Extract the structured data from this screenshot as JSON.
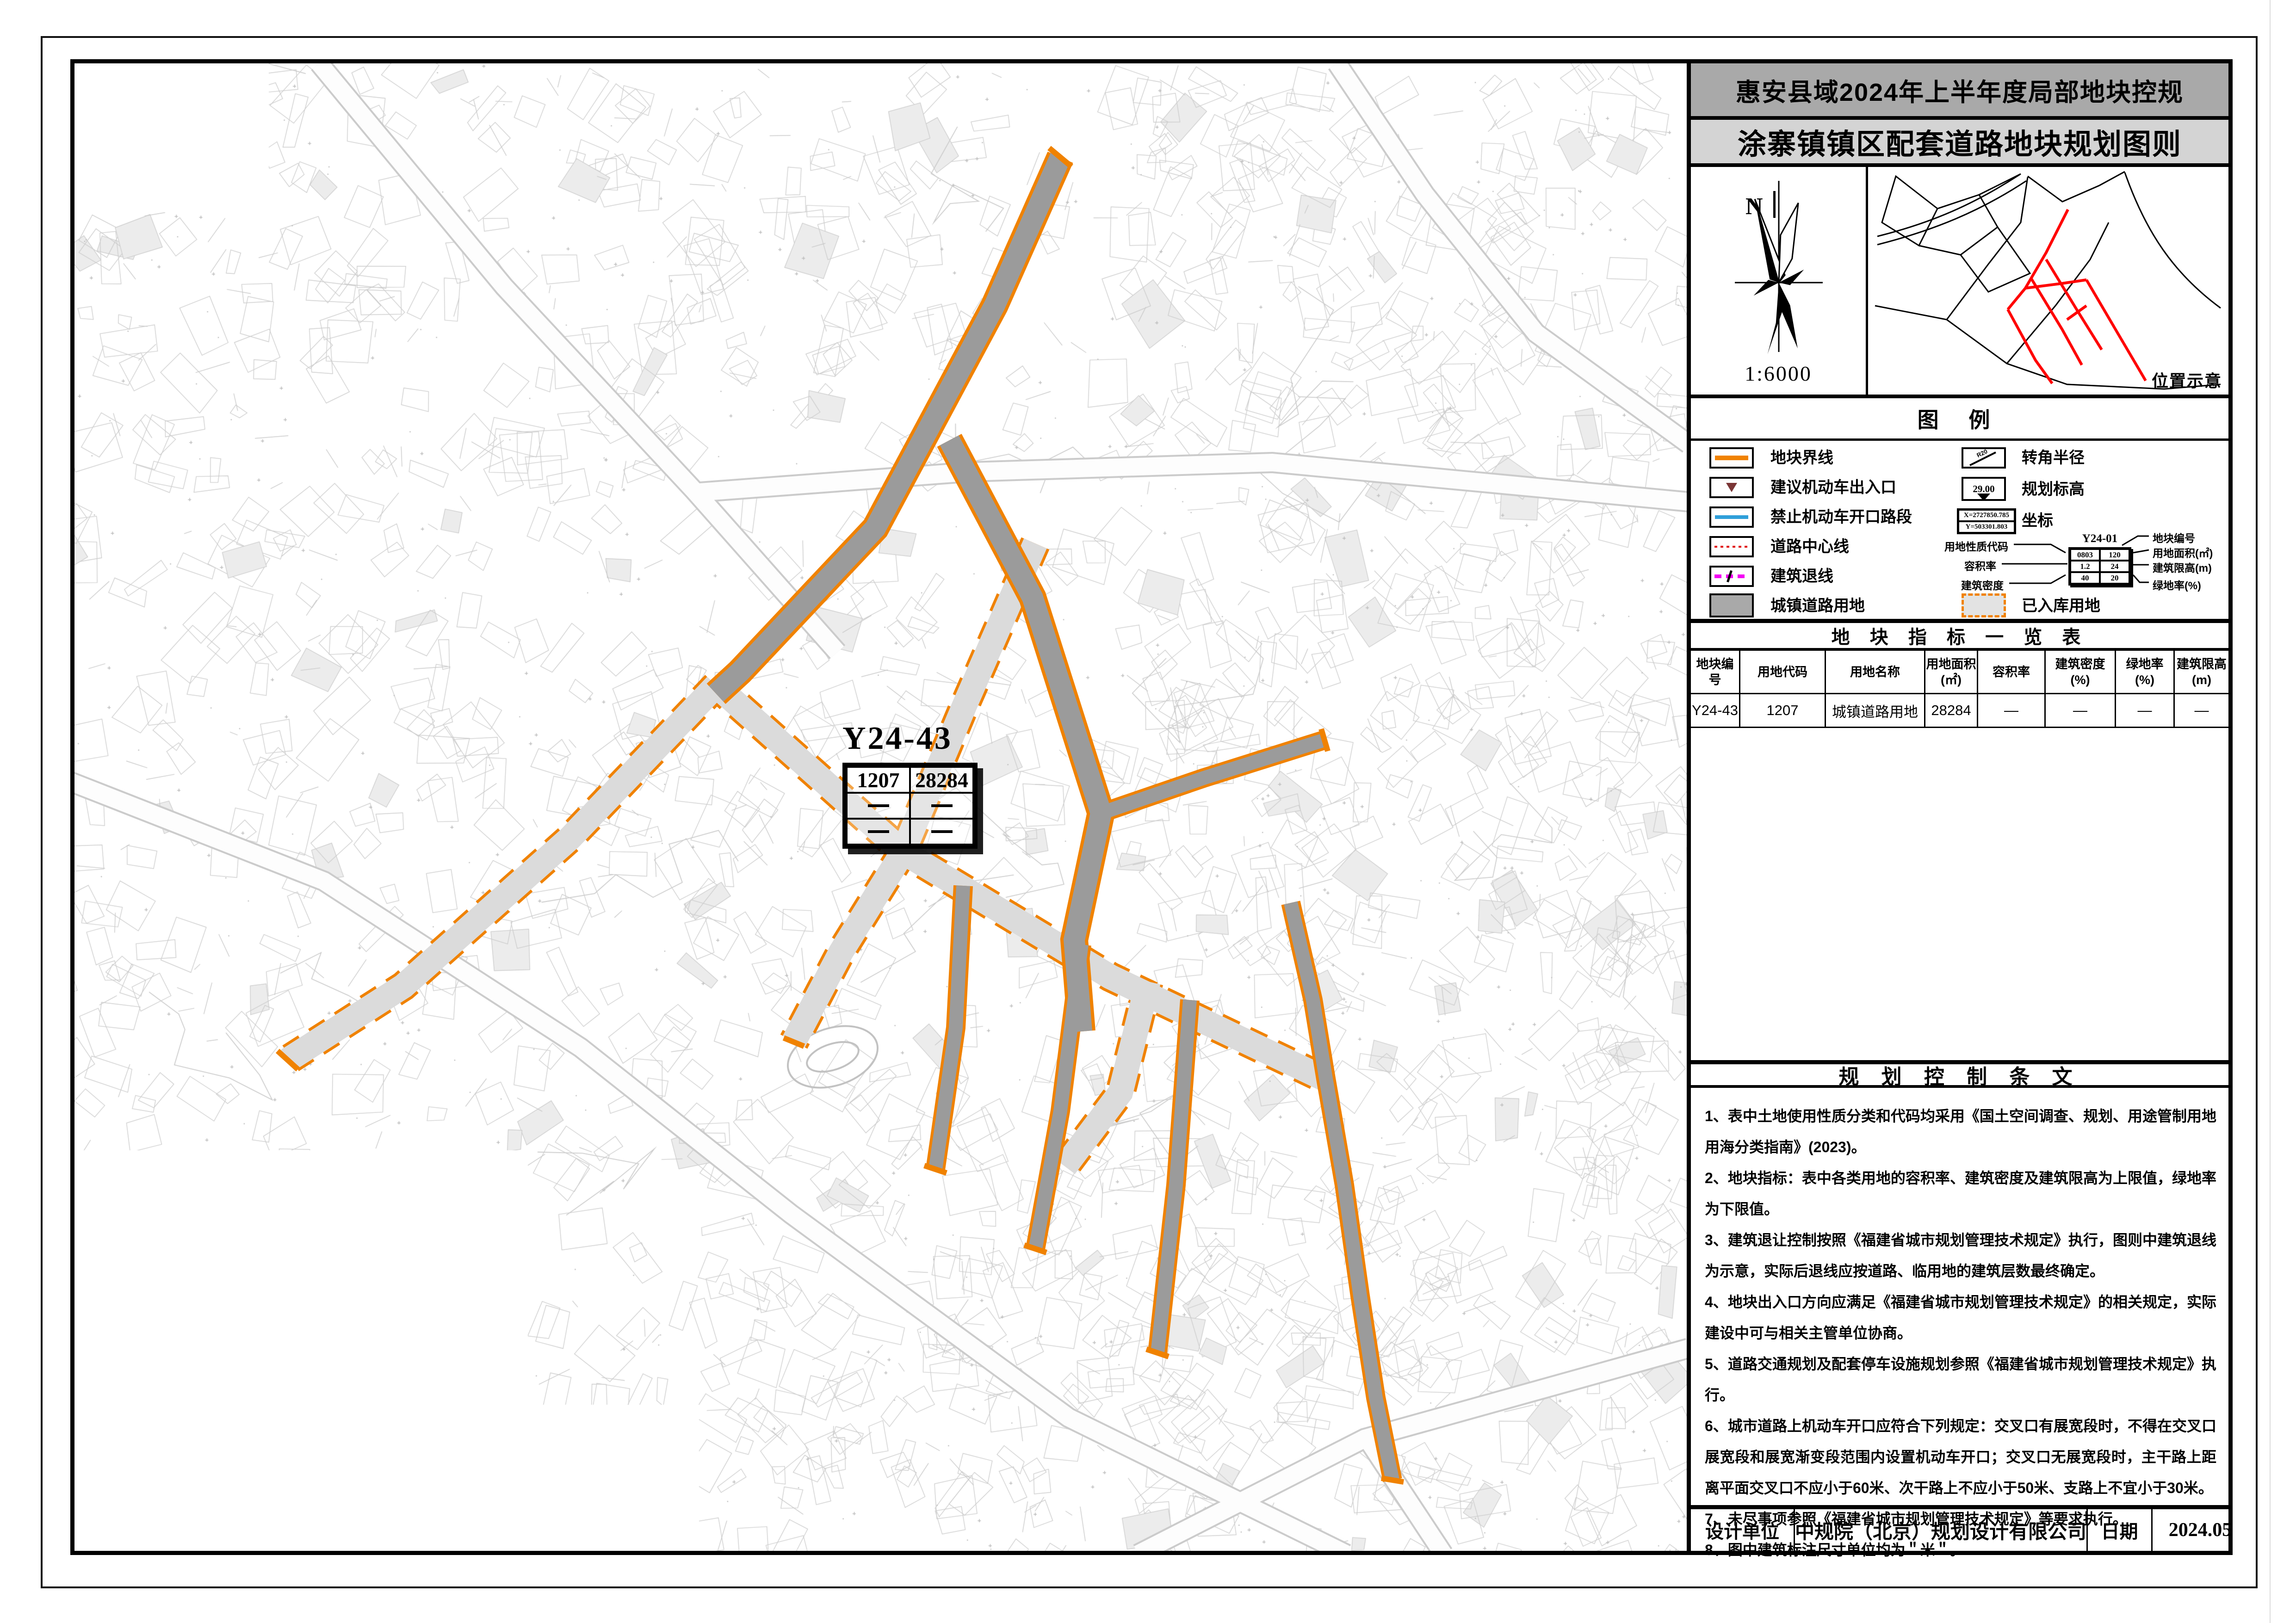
{
  "page": {
    "title1": "惠安县域2024年上半年度局部地块控规",
    "title2": "涂寨镇镇区配套道路地块规划图则"
  },
  "compass": {
    "north_label": "N",
    "scale": "1:6000"
  },
  "inset": {
    "caption": "位置示意"
  },
  "legend": {
    "title": "图  例",
    "left": [
      {
        "label": "地块界线"
      },
      {
        "label": "建议机动车出入口"
      },
      {
        "label": "禁止机动车开口路段"
      },
      {
        "label": "道路中心线"
      },
      {
        "label": "建筑退线"
      },
      {
        "label": "城镇道路用地"
      }
    ],
    "right": [
      {
        "label": "转角半径",
        "icon_text": "R20"
      },
      {
        "label": "规划标高",
        "value": "29.00"
      },
      {
        "label": "坐标",
        "x": "X=2727850.785",
        "y": "Y=503301.803"
      },
      {
        "label": "已入库用地"
      }
    ],
    "indicator": {
      "plot_no": "Y24-01",
      "rows": [
        [
          "0803",
          "120"
        ],
        [
          "1.2",
          "24"
        ],
        [
          "40",
          "20"
        ]
      ],
      "callouts_left": [
        "用地性质代码",
        "容积率",
        "建筑密度"
      ],
      "callouts_right": [
        "地块编号",
        "用地面积(㎡)",
        "建筑限高(m)",
        "绿地率(%)"
      ]
    }
  },
  "metrics_table": {
    "title": "地 块 指 标 一 览 表",
    "headers": [
      "地块编号",
      "用地代码",
      "用地名称",
      "用地面积\n(㎡)",
      "容积率",
      "建筑密度\n(%)",
      "绿地率\n(%)",
      "建筑限高\n(m)"
    ],
    "rows": [
      [
        "Y24-43",
        "1207",
        "城镇道路用地",
        "28284",
        "—",
        "—",
        "—",
        "—"
      ]
    ]
  },
  "map_label": {
    "plot_no": "Y24-43",
    "land_code": "1207",
    "area": "28284"
  },
  "notes": {
    "title": "规 划 控 制 条 文",
    "items": [
      "1、表中土地使用性质分类和代码均采用《国土空间调查、规划、用途管制用地用海分类指南》(2023)。",
      "2、地块指标：表中各类用地的容积率、建筑密度及建筑限高为上限值，绿地率为下限值。",
      "3、建筑退让控制按照《福建省城市规划管理技术规定》执行，图则中建筑退线为示意，实际后退线应按道路、临用地的建筑层数最终确定。",
      "4、地块出入口方向应满足《福建省城市规划管理技术规定》的相关规定，实际建设中可与相关主管单位协商。",
      "5、道路交通规划及配套停车设施规划参照《福建省城市规划管理技术规定》执行。",
      "6、城市道路上机动车开口应符合下列规定：交叉口有展宽段时，不得在交叉口展宽段和展宽渐变段范围内设置机动车开口；交叉口无展宽段时，主干路上距离平面交叉口不应小于60米、次干路上不应小于50米、支路上不宜小于30米。",
      "7、未尽事项参照《福建省城市规划管理技术规定》等要求执行。",
      "8、图中建筑标注尺寸单位均为＂米＂。"
    ]
  },
  "footer": {
    "design_label": "设计单位",
    "design_value": "中规院（北京）规划设计有限公司",
    "date_label": "日期",
    "date_value": "2024.05"
  },
  "colors": {
    "accent_orange": "#f08200",
    "road_dark": "#9b9b9b",
    "road_light": "#dbdbdb",
    "no_open_blue": "#2f9fd9",
    "setback_magenta": "#f400f4",
    "centerline_red": "#e00000",
    "entry_maroon": "#7a3535",
    "titlebar_dark": "#a9a9a9",
    "titlebar_light": "#d4d4d4",
    "inset_highlight_red": "#ff0000"
  }
}
